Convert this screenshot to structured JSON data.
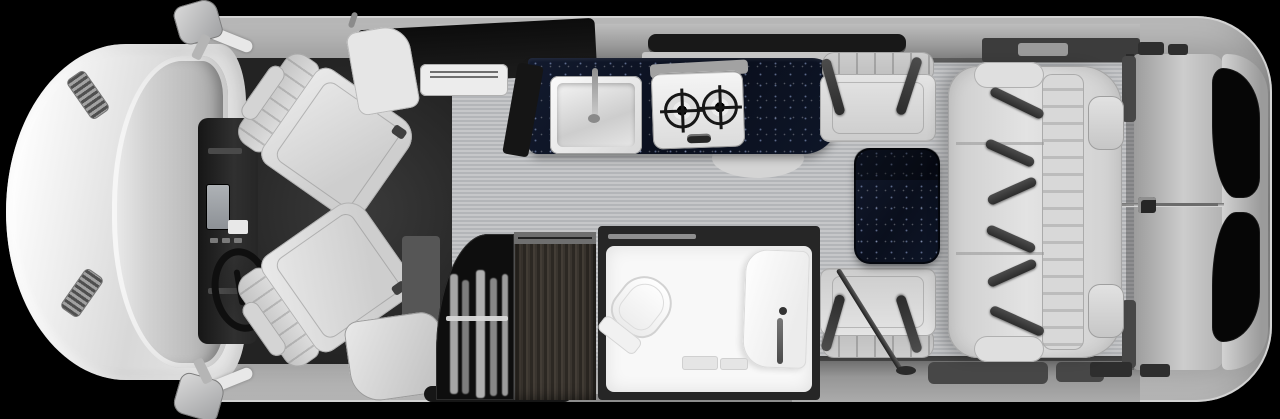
{
  "scene": {
    "title": "Motorhome floor plan — top-down view",
    "background": "#000000",
    "vehicle_orientation": "front at left, rear at right"
  },
  "palette": {
    "background": "#000000",
    "shell": "#8f8f8f",
    "shell_light": "#c9c9c9",
    "hood": "#f2f2f2",
    "glass": "#c2c4c6",
    "cab_floor": "#2b2b2b",
    "floor": "#c6c7c9",
    "floor_stripe": "#b3b5b8",
    "wall_dark": "#3c3c3c",
    "counter_navy": "#0c1322",
    "seat": "#d9d9d9",
    "belt": "#3a3a3a",
    "wood": "#37322d",
    "bath": "#f8f8f8",
    "window": "#060606",
    "closet": "#0e0e0e"
  },
  "components": {
    "vehicle": {
      "label": "Class B motorhome floor plan, top-down view, cab at left"
    },
    "cab": {
      "label": "Cab with two rear-facing swivel captain chairs"
    },
    "passenger_seat": {
      "label": "Passenger swivel captain chair"
    },
    "driver_seat": {
      "label": "Driver swivel captain chair"
    },
    "steering_wheel": {
      "label": "Steering wheel"
    },
    "dashboard": {
      "label": "Dashboard console"
    },
    "mirror_top": {
      "label": "Passenger-side exterior mirror"
    },
    "mirror_bottom": {
      "label": "Driver-side exterior mirror"
    },
    "galley": {
      "label": "Galley with dark solid-surface countertop"
    },
    "sink": {
      "label": "Galley sink with faucet"
    },
    "cooktop": {
      "label": "Two-burner cooktop"
    },
    "overhead_cabinet": {
      "label": "Overhead cabinet"
    },
    "vent_unit": {
      "label": "Vent unit"
    },
    "window_galley": {
      "label": "Galley window"
    },
    "wardrobe": {
      "label": "Wardrobe with hanging clothes"
    },
    "cabinet_wood": {
      "label": "Wood cabinetry"
    },
    "wet_bath": {
      "label": "Wet bath"
    },
    "toilet": {
      "label": "Toilet"
    },
    "shower": {
      "label": "Shower and vanity column"
    },
    "dinette_front_seat": {
      "label": "Forward dinette seat with seatbelt"
    },
    "dinette_rear_seat": {
      "label": "Rear dinette seat with seatbelt"
    },
    "dinette_table": {
      "label": "Pedestal dinette table"
    },
    "sofa": {
      "label": "Three-place belted sofa"
    },
    "rear_bed": {
      "label": "Rear bed platform"
    },
    "rear_doors": {
      "label": "Rear doors with tinted windows"
    },
    "entry_step": {
      "label": "Entry step"
    }
  }
}
